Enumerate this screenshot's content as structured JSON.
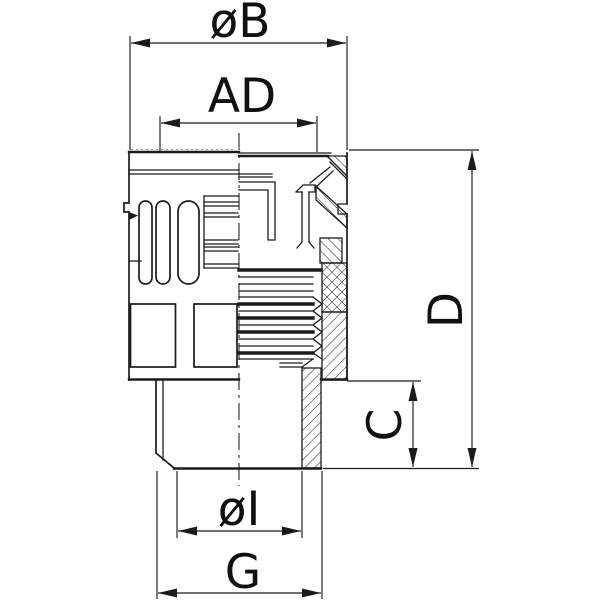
{
  "drawing": {
    "background_color": "#ffffff",
    "line_color": "#1b1b1b",
    "figure": "cable-gland-half-section-technical-drawing",
    "dimensions": {
      "b": {
        "label": "øB"
      },
      "ad": {
        "label": "AD"
      },
      "d": {
        "label": "D"
      },
      "c": {
        "label": "C"
      },
      "i": {
        "label": "øI"
      },
      "g": {
        "label": "G"
      }
    }
  }
}
